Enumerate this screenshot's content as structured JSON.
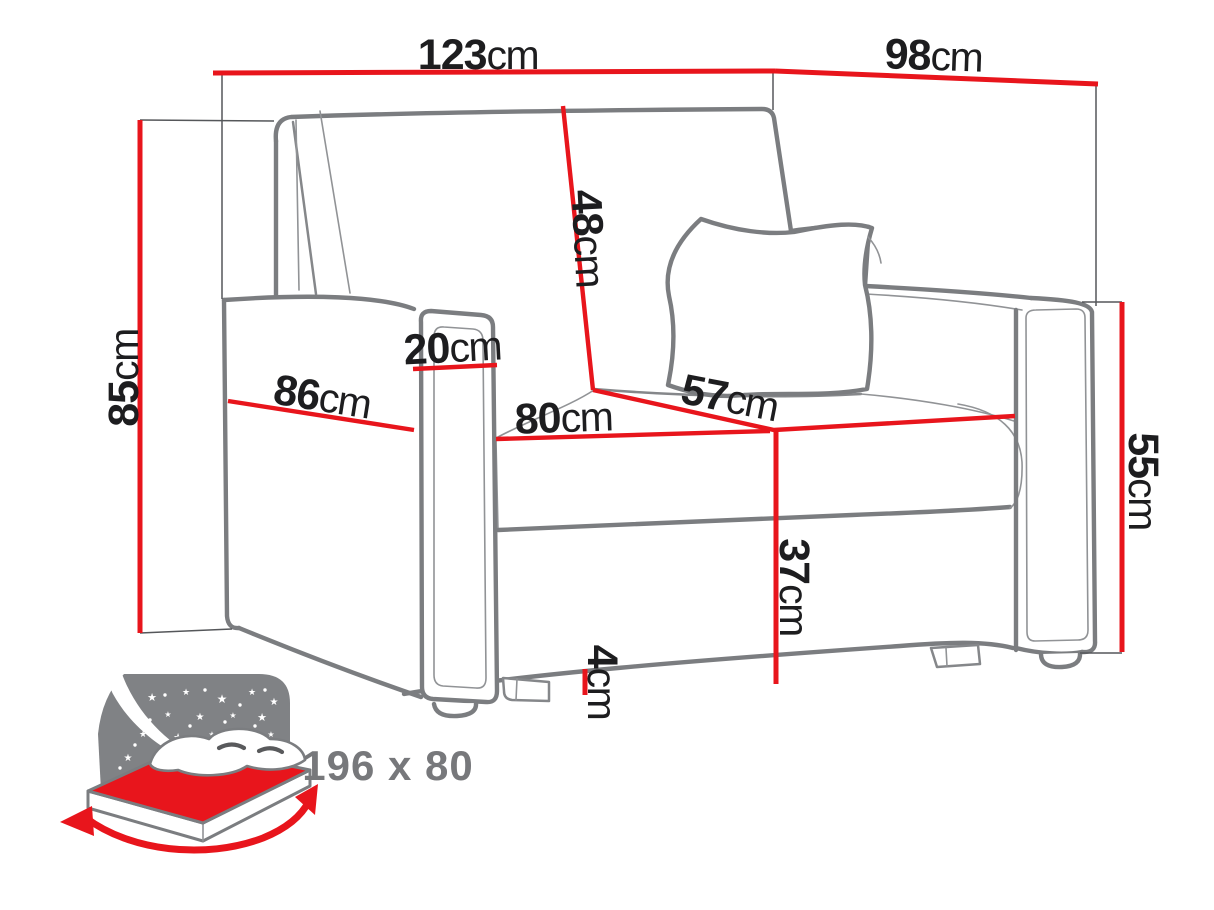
{
  "diagram": {
    "subject": "armchair sofa-bed dimensions",
    "unit": "cm",
    "colors": {
      "dimension_red": "#e8151c",
      "line_gray": "#7b7d80",
      "label_black": "#1d1d1f",
      "icon_gray": "#808285",
      "icon_text_gray": "#77787b"
    }
  },
  "dimensions": {
    "total_width": {
      "value": "123",
      "unit": "cm"
    },
    "total_depth": {
      "value": "98",
      "unit": "cm"
    },
    "total_height": {
      "value": "85",
      "unit": "cm"
    },
    "backrest_height": {
      "value": "48",
      "unit": "cm"
    },
    "armrest_width": {
      "value": "20",
      "unit": "cm"
    },
    "side_depth": {
      "value": "86",
      "unit": "cm"
    },
    "seat_width": {
      "value": "80",
      "unit": "cm"
    },
    "seat_depth": {
      "value": "57",
      "unit": "cm"
    },
    "armrest_height": {
      "value": "55",
      "unit": "cm"
    },
    "seat_height": {
      "value": "37",
      "unit": "cm"
    },
    "leg_height": {
      "value": "4",
      "unit": "cm"
    }
  },
  "sleeping_area": {
    "size_label": "196 x 80"
  }
}
